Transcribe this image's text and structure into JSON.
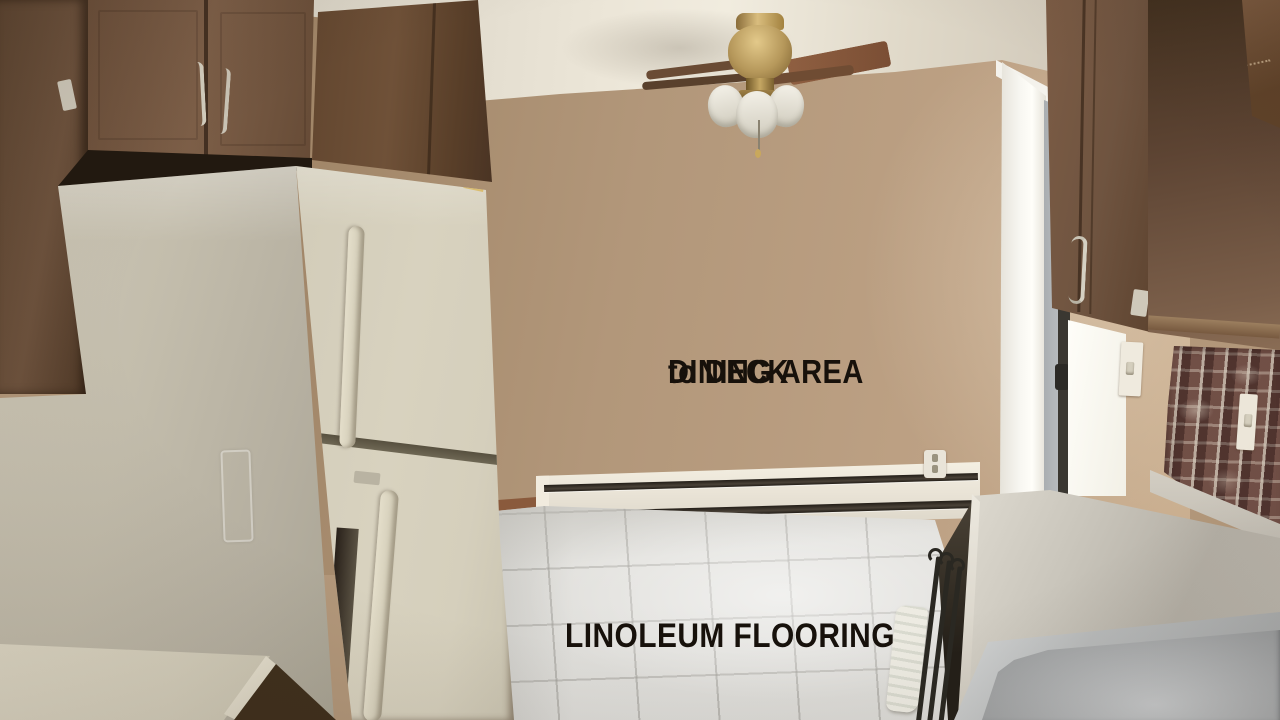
{
  "image": {
    "kind": "real-estate listing photo",
    "scene": "kitchen and dining area with linoleum flooring"
  },
  "overlays": {
    "dining": {
      "line1": "DINING AREA",
      "line2": "to DECK"
    },
    "flooring": "LINOLEUM FLOORING"
  },
  "palette": {
    "wall": "#b2977a",
    "ceiling": "#ece6d8",
    "cabinet": "#6f5440",
    "cabinetDark": "#4a3424",
    "cabinetLight": "#7d5f48",
    "fridgeSide": "#c3bdac",
    "fridgeFront": "#d8d2bf",
    "handleCream": "#e4deca",
    "floor": "#e3e2de",
    "counter": "#c8c4ba",
    "counterLight": "#dfdbd1",
    "brick": "#6a4a42",
    "heater": "#e9e3d6",
    "brass": "#b5975a",
    "steel": "#a4a6a7",
    "doorWhite": "#f8f7f2",
    "glassGray": "#bcc0c3",
    "rugWhite": "#edebe2",
    "metal": "#2a2822",
    "textColor": "#17110b"
  },
  "scene_objects": [
    "ceiling-fan",
    "refrigerator",
    "upper-cabinets-left",
    "upper-cabinets-right",
    "dining-area-wall",
    "baseboard-heater",
    "electrical-outlet",
    "sliding-glass-door",
    "light-switches",
    "brick-backsplash",
    "countertop",
    "stainless-sink",
    "linoleum-floor",
    "rug",
    "metal-rack",
    "decorative-object"
  ]
}
